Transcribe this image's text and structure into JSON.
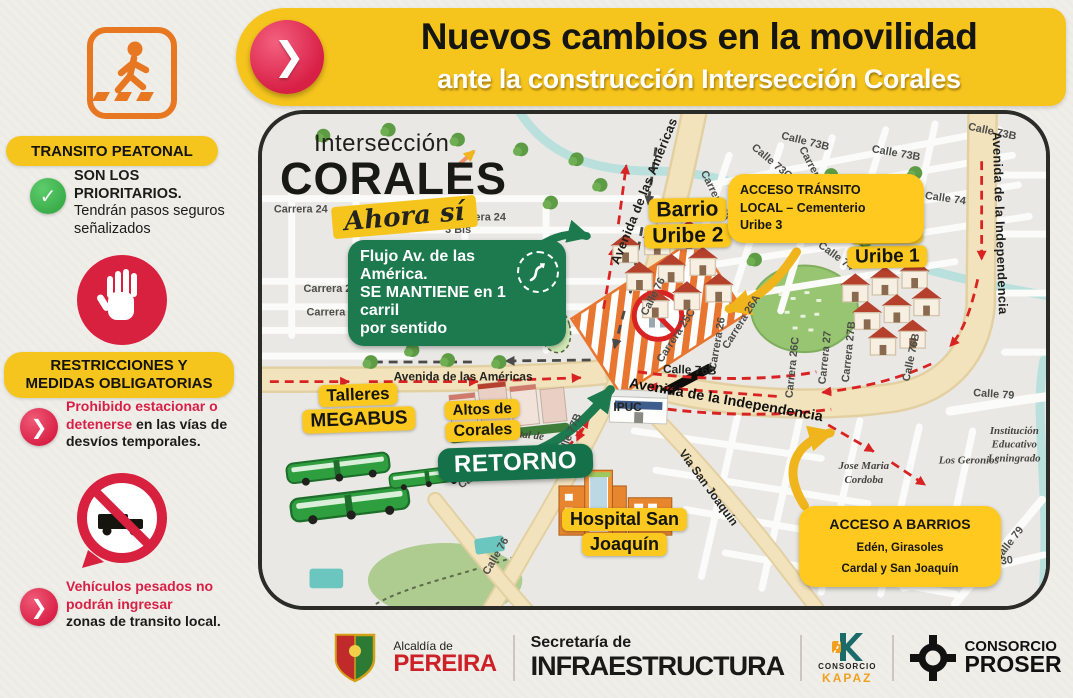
{
  "banner": {
    "title": "Nuevos cambios en la movilidad",
    "subtitle": "ante la construcción Intersección Corales"
  },
  "icons": {
    "chevron": "❯",
    "check": "✓"
  },
  "sidebar": {
    "pedestrian_heading": "TRANSITO PEATONAL",
    "pedestrian_bold": "SON LOS PRIORITARIOS.",
    "pedestrian_text": "Tendrán pasos seguros señalizados",
    "restrictions_heading1": "RESTRICCIONES Y",
    "restrictions_heading2": "MEDIDAS OBLIGATORIAS",
    "parking_red": "Prohibido estacionar o detenerse",
    "parking_rest": " en las vías de desvíos temporales.",
    "trucks_red": "Vehículos pesados no podrán ingresar",
    "trucks_rest": "zonas de transito local."
  },
  "map": {
    "logo_line1": "Intersección",
    "logo_line2": "CORALES",
    "logo_line3": "Ahora sí",
    "badges": {
      "uribe2_1": "Barrio",
      "uribe2_2": "Uribe 2",
      "uribe1_1": "Barrio",
      "uribe1_2": "Uribe 1",
      "talleres_1": "Talleres",
      "talleres_2": "MEGABUS",
      "altos_1": "Altos de",
      "altos_2": "Corales",
      "retorno": "RETORNO",
      "hospital_1": "Hospital San",
      "hospital_2": "Joaquín"
    },
    "callouts": {
      "flujo_1": "Flujo Av. de las América.",
      "flujo_2": "SE MANTIENE en 1 carril",
      "flujo_3": "por sentido",
      "acceso_transito_1": "ACCESO TRÁNSITO",
      "acceso_transito_2": "LOCAL – Cementerio",
      "acceso_transito_3": "Uribe 3",
      "acceso_barrios_1": "ACCESO A BARRIOS",
      "acceso_barrios_2": "Edén, Girasoles",
      "acceso_barrios_3": "Cardal y San Joaquín"
    },
    "streets": [
      "Carrera 24",
      "Carrera 24",
      "3 Bis",
      "Carrera 26",
      "Carrera 27",
      "Carrera 27",
      "Avenida de las Américas",
      "Avenida de las Américas",
      "Calle 73B",
      "Calle 73B",
      "Calle 73B",
      "Calle 73C",
      "Carrera 26B",
      "Carrera 25",
      "Calle 74",
      "Calle 73C",
      "Calle 74",
      "Avenida de la Independencia",
      "Avenida de la Independencia",
      "Calle 76",
      "Carrera 25C",
      "Carrera 26",
      "Carrera 26A",
      "Carrera 26C",
      "Carrera 27",
      "Carrera 27B",
      "Calle 76B",
      "Calle 76B",
      "Calle 79",
      "Calle 79",
      "Carrera 30",
      "Carrera 28D",
      "Jose Maria",
      "Cordoba",
      "Los Geronios",
      "Institución",
      "Educativo",
      "Leningrado",
      "Calle 77B",
      "Via San Joaquín",
      "IPUC",
      "Portal de",
      "Carrera 29",
      "Calle 76"
    ]
  },
  "footer": {
    "alcaldia_small": "Alcaldía de",
    "alcaldia_big": "PEREIRA",
    "secretaria_small": "Secretaría de",
    "secretaria_big": "INFRAESTRUCTURA",
    "kapaz_small": "CONSORCIO",
    "kapaz_big": "KAPAZ",
    "proser_small": "CONSORCIO",
    "proser_big": "PROSER"
  },
  "colors": {
    "banner_yellow": "#f6c51d",
    "accent_red": "#d81f45",
    "green": "#1d7a4f",
    "callout_yellow": "#ffc91f",
    "road_beige": "#f3e3bd",
    "route_red": "#d92323",
    "route_dark": "#4a4a48"
  }
}
